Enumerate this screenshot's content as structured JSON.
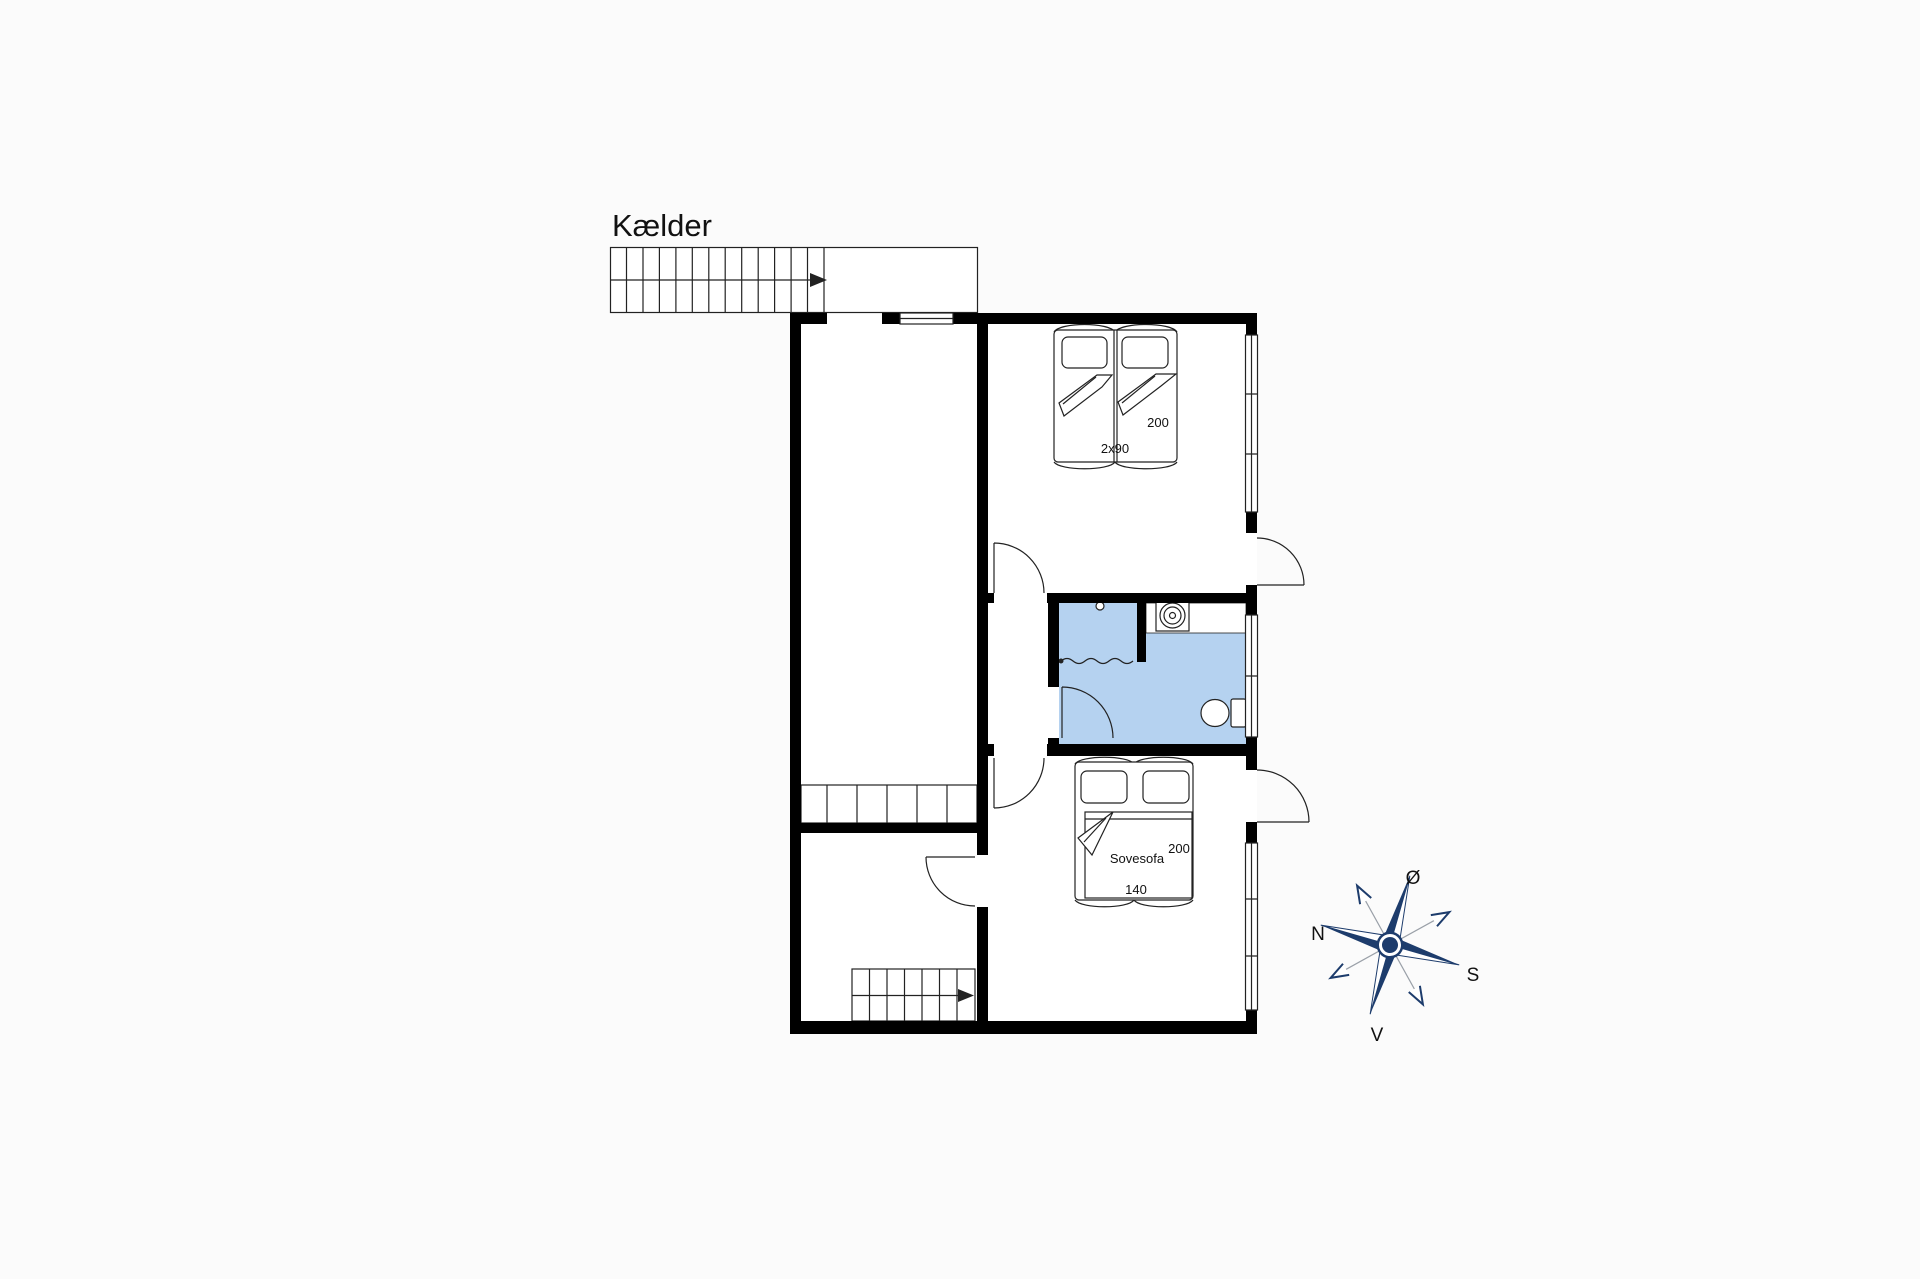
{
  "page": {
    "background": "#fbfbfb"
  },
  "colors": {
    "background": "#fbfbfb",
    "wall": "#000000",
    "line": "#222222",
    "text": "#111111",
    "bathroom_fill": "#b5d2f0",
    "compass_navy": "#1d3c6c"
  },
  "plan": {
    "title": "Kælder",
    "labels": {
      "double_bed_length": "200",
      "double_bed_width": "2x90",
      "sofa_bed_name": "Sovesofa",
      "sofa_bed_length": "200",
      "sofa_bed_width": "140"
    },
    "icons": {
      "compass_rose": "wind-rose-star",
      "stairs_up": "stair-treads-with-arrow",
      "shower": "blue-square-with-curtain",
      "sink": "scalloped-circle-in-square",
      "toilet": "oval-bowl-with-tank",
      "window": "double-line-rectangle",
      "door": "quarter-arc-with-leaf"
    }
  },
  "compass": {
    "north_label": "N",
    "south_label": "S",
    "east_label": "Ø",
    "west_label": "V"
  }
}
